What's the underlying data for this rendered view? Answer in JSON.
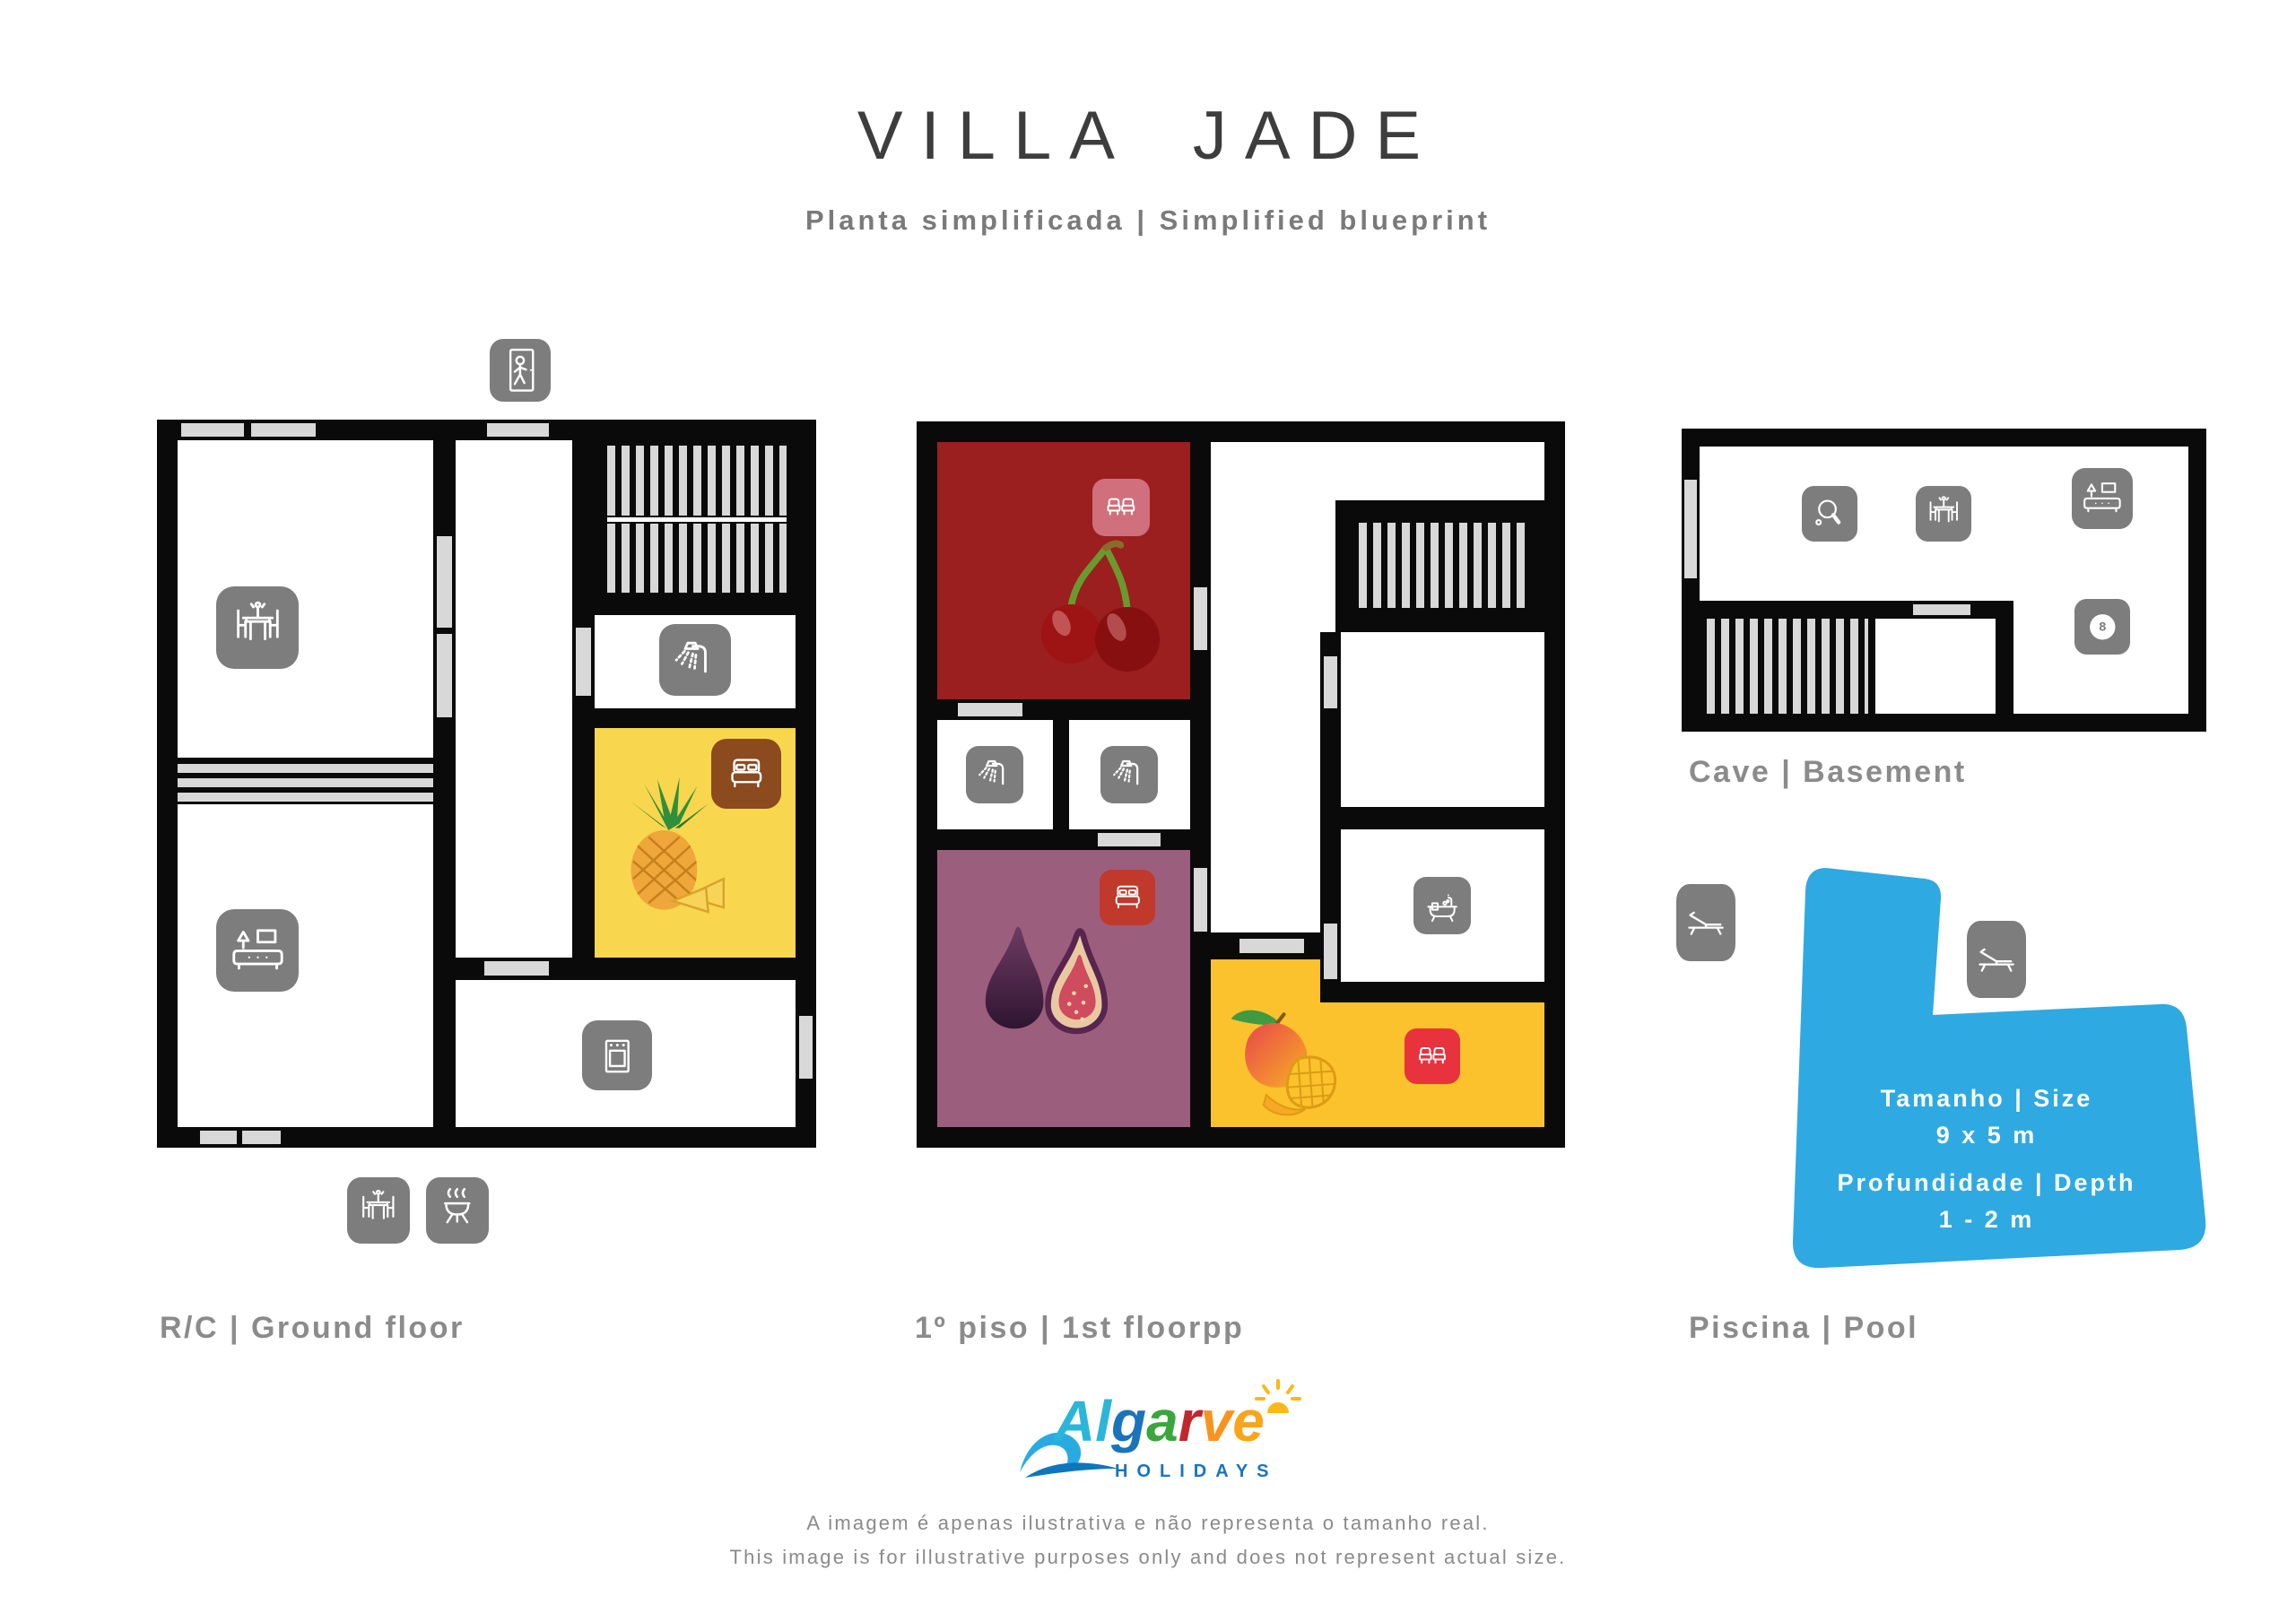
{
  "header": {
    "title": "VILLA JADE",
    "subtitle": "Planta simplificada | Simplified blueprint"
  },
  "floors": {
    "ground": {
      "label": "R/C | Ground floor",
      "icons": [
        "entrance-walk",
        "dining-table",
        "sofa-living",
        "shower",
        "double-bed",
        "oven",
        "outdoor-dining-table",
        "barbecue"
      ]
    },
    "first": {
      "label": "1º piso | 1st floorpp",
      "icons": [
        "twin-beds",
        "shower",
        "shower",
        "double-bed",
        "bathtub",
        "twin-beds"
      ]
    },
    "basement": {
      "label": "Cave | Basement",
      "icons": [
        "ping-pong",
        "dining-table",
        "sofa-tv",
        "billiards-8-ball"
      ]
    },
    "pool": {
      "label": "Piscina | Pool",
      "size_label": "Tamanho | Size",
      "size_value": "9 x 5 m",
      "depth_label": "Profundidade | Depth",
      "depth_value": "1 - 2 m",
      "icons": [
        "sun-lounger",
        "sun-lounger"
      ]
    }
  },
  "logo": {
    "letters": [
      {
        "ch": "A",
        "color": "#2bb6d9"
      },
      {
        "ch": "l",
        "color": "#2bb6d9"
      },
      {
        "ch": "g",
        "color": "#1a74bb"
      },
      {
        "ch": "a",
        "color": "#3aa63c"
      },
      {
        "ch": "r",
        "color": "#c1272d"
      },
      {
        "ch": "v",
        "color": "#f7941e"
      },
      {
        "ch": "e",
        "color": "#f9a51a"
      }
    ],
    "sub": "HOLIDAYS"
  },
  "disclaimer": {
    "pt": "A imagem é apenas ilustrativa e não representa o tamanho real.",
    "en": "This image is for illustrative purposes only and does not represent actual size."
  },
  "colors": {
    "wall": "#0a0a0a",
    "door": "#d8d8d8",
    "icon_grey": "#7d7d7d",
    "room_cherry": "#9b1f1f",
    "room_fig": "#9c5e7d",
    "room_pineapple": "#f8d64e",
    "room_mango": "#fbc22d",
    "icon_pink": "#cf707c",
    "icon_red": "#e8323e",
    "icon_darkred": "#c0392b",
    "icon_brown": "#8c4a1f",
    "pool_blue": "#2fa9e1",
    "label_grey": "#8b8b8b",
    "title_grey": "#3d3d3d",
    "subtitle_grey": "#7a7a7a"
  }
}
